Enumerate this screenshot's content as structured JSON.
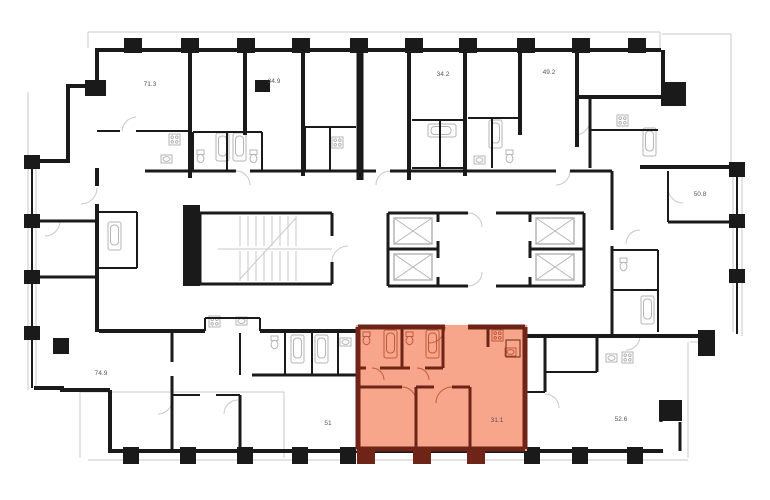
{
  "plan": {
    "type": "residential-floor-plan",
    "colors": {
      "wall": "#1a1a1a",
      "detail": "#c9c9c9",
      "fixture": "#b5b5b5",
      "text": "#555555",
      "background": "#ffffff",
      "highlight_fill": "#f7a68c",
      "highlight_wall": "#6e2517",
      "highlight_fixture": "#c05a3e"
    },
    "units": [
      {
        "label": "71.3",
        "highlighted": false
      },
      {
        "label": "34.9",
        "highlighted": false
      },
      {
        "label": "34.2",
        "highlighted": false
      },
      {
        "label": "49.2",
        "highlighted": false
      },
      {
        "label": "50.8",
        "highlighted": false
      },
      {
        "label": "74.9",
        "highlighted": false
      },
      {
        "label": "51",
        "highlighted": false
      },
      {
        "label": "31.1",
        "highlighted": true
      },
      {
        "label": "52.6",
        "highlighted": false
      }
    ]
  }
}
